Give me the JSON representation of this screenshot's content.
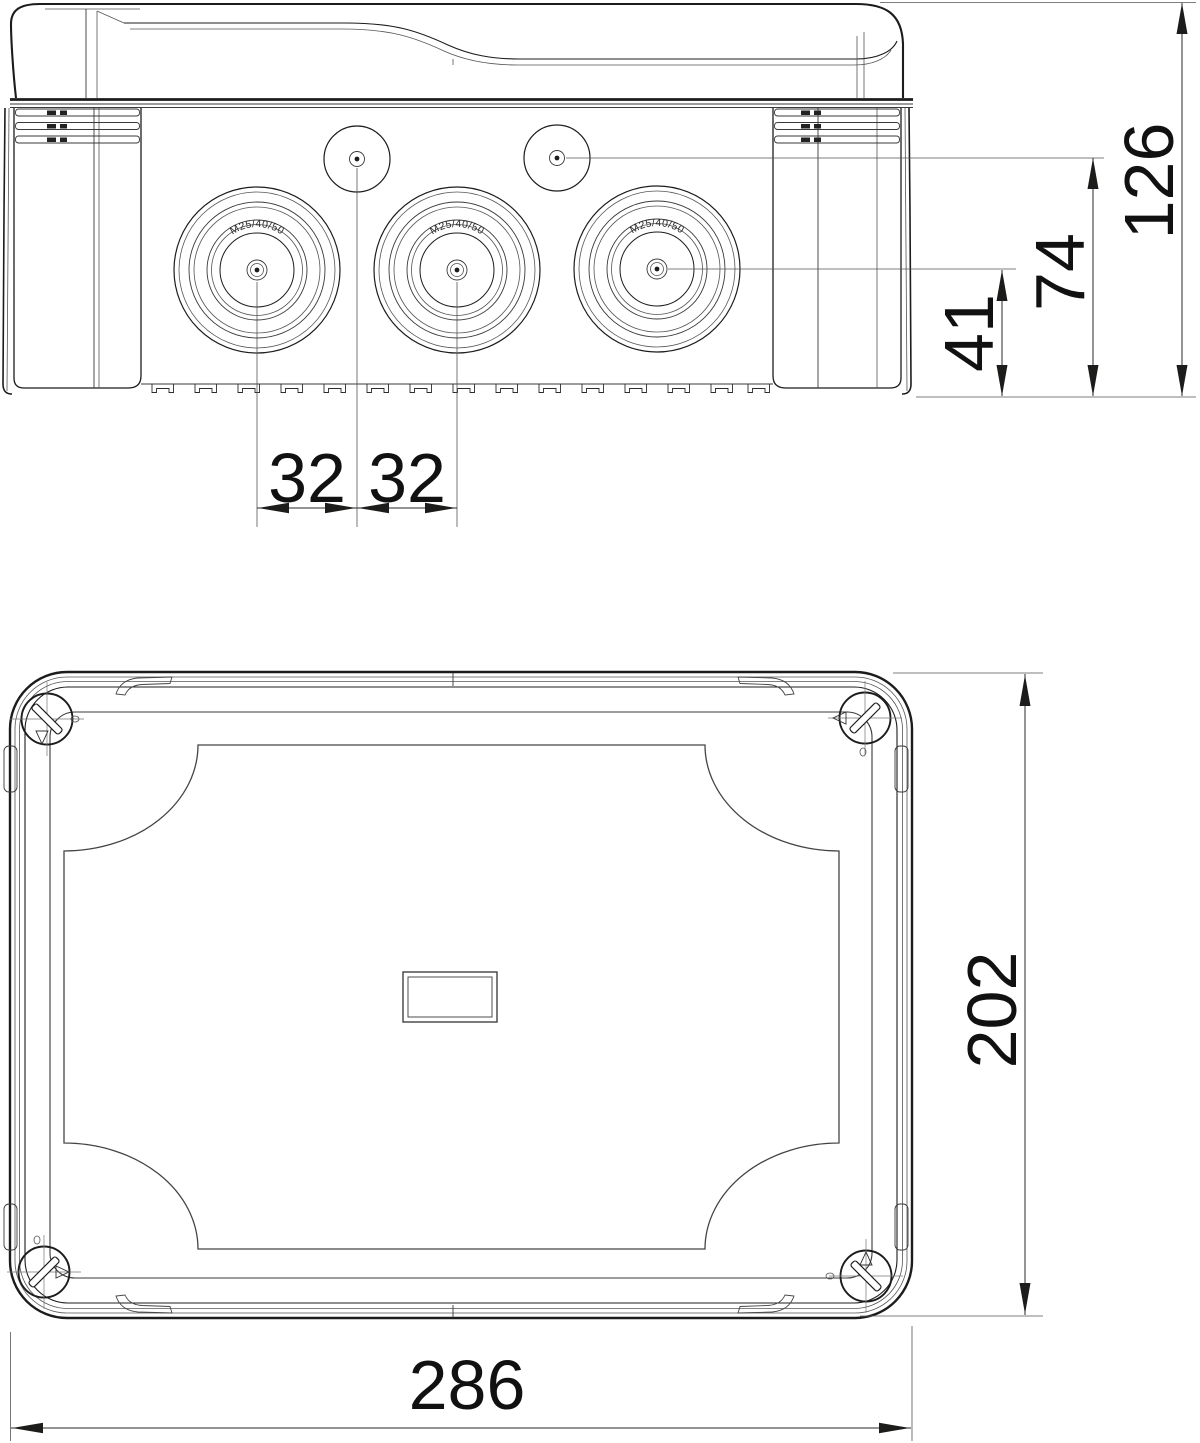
{
  "drawing": {
    "colors": {
      "background": "#ffffff",
      "line": "#1c1c1b",
      "dimension_text": "#111111"
    },
    "views": {
      "front": {
        "knockout_marking": "M25/40/50",
        "dims": {
          "knockout_spacing_left": "32",
          "knockout_spacing_right": "32",
          "large_knockout_axis_height": "41",
          "small_knockout_axis_height": "74",
          "overall_height": "126"
        }
      },
      "plan": {
        "dims": {
          "overall_length": "286",
          "overall_width": "202"
        }
      }
    }
  }
}
